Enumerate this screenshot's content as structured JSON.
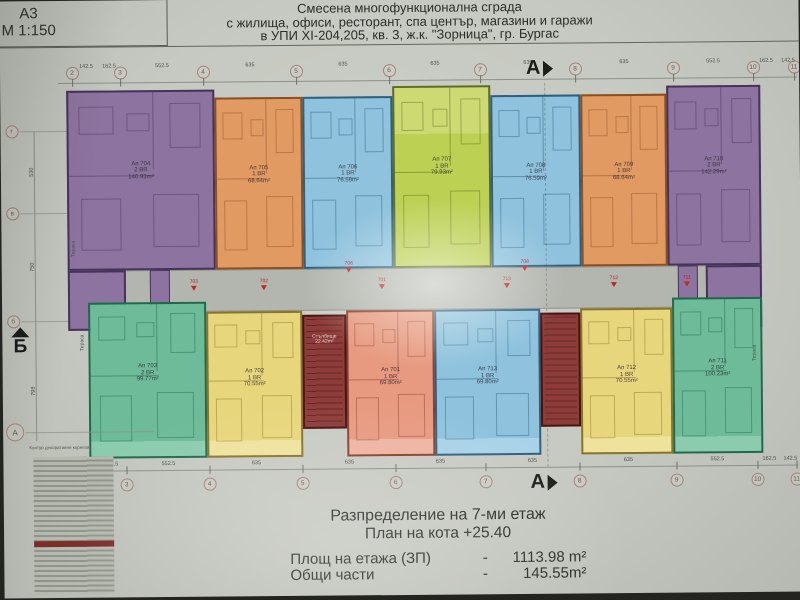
{
  "sheet": {
    "format": "А3",
    "scale": "М 1:150"
  },
  "title": {
    "line1": "Смесена многофункционална сграда",
    "line2": "с жилища, офиси, ресторант, спа център, магазини и  гаражи",
    "line3": "в УПИ XI-204,205, кв. 3, ж.к. \"Зорница\", гр. Бургас"
  },
  "caption": {
    "heading": "Разпределение на 7-ми  етаж",
    "subheading": "План на кота  +25.40",
    "rows": [
      {
        "label": "Площ на етажа (ЗП)",
        "dash": "-",
        "value": "1113.98 m²"
      },
      {
        "label": "Общи части",
        "dash": "-",
        "value": "145.55m²"
      }
    ]
  },
  "plan": {
    "corridor": {
      "x": 70,
      "y": 270,
      "w": 688,
      "h": 42,
      "fill": "#b3b6af",
      "wall": "#90938c"
    },
    "apartments": [
      {
        "no": "Ап 704",
        "type": "2 BR",
        "area": "140.93m²",
        "x": 66,
        "y": 90,
        "w": 148,
        "h": 180,
        "fill": "#8d74a0",
        "wall": "#46335a",
        "light": "#a18bb3",
        "balcony": null,
        "wing": [
          66,
          270,
          58,
          60
        ]
      },
      {
        "no": "Ап 705",
        "type": "1 BR",
        "area": "68.64m²",
        "x": 214,
        "y": 98,
        "w": 88,
        "h": 172,
        "fill": "#e29a63",
        "wall": "#8a4f23",
        "light": "#ecb384",
        "balcony": null
      },
      {
        "no": "Ап 706",
        "type": "1 BR",
        "area": "76.59m²",
        "x": 302,
        "y": 98,
        "w": 90,
        "h": 172,
        "fill": "#8ec2dd",
        "wall": "#2f5f7e",
        "light": "#a8d2e8",
        "balcony": null
      },
      {
        "no": "Ап 707",
        "type": "1 BR",
        "area": "79.93m²",
        "x": 392,
        "y": 88,
        "w": 98,
        "h": 182,
        "fill": "#bcd054",
        "wall": "#5c6c1d",
        "light": "#cdda74",
        "balcony": "top"
      },
      {
        "no": "Ап 708",
        "type": "1 BR",
        "area": "76.59m²",
        "x": 490,
        "y": 98,
        "w": 90,
        "h": 172,
        "fill": "#8ec2dd",
        "wall": "#2f5f7e",
        "light": "#a8d2e8",
        "balcony": null
      },
      {
        "no": "Ап 709",
        "type": "1 BR",
        "area": "68.64m²",
        "x": 580,
        "y": 98,
        "w": 86,
        "h": 172,
        "fill": "#e29a63",
        "wall": "#8a4f23",
        "light": "#ecb384",
        "balcony": null
      },
      {
        "no": "Ап 710",
        "type": "2 BR",
        "area": "142.29m²",
        "x": 666,
        "y": 90,
        "w": 94,
        "h": 180,
        "fill": "#8d74a0",
        "wall": "#46335a",
        "light": "#a18bb3",
        "balcony": null,
        "wing": [
          704,
          270,
          56,
          62
        ]
      },
      {
        "no": "Ап 703",
        "type": "2 BR",
        "area": "99.77m²",
        "x": 86,
        "y": 302,
        "w": 118,
        "h": 156,
        "fill": "#6dbb98",
        "wall": "#1f6a4d",
        "light": "#8bcbae",
        "balcony": "bottom"
      },
      {
        "no": "Ап 702",
        "type": "1 BR",
        "area": "70.55m²",
        "x": 204,
        "y": 312,
        "w": 96,
        "h": 146,
        "fill": "#e8d67c",
        "wall": "#8a7526",
        "light": "#efe29d",
        "balcony": "bottom"
      },
      {
        "no": "Ап 701",
        "type": "1 BR",
        "area": "69.80m²",
        "x": 344,
        "y": 312,
        "w": 88,
        "h": 146,
        "fill": "#e79a80",
        "wall": "#8a3d2a",
        "light": "#eeb3a0",
        "balcony": "bottom"
      },
      {
        "no": "Ап 713",
        "type": "1 BR",
        "area": "69.80m²",
        "x": 432,
        "y": 312,
        "w": 106,
        "h": 146,
        "fill": "#8ec2dd",
        "wall": "#2f5f7e",
        "light": "#a8d2e8",
        "balcony": "bottom"
      },
      {
        "no": "Ап 712",
        "type": "1 BR",
        "area": "70.55m²",
        "x": 578,
        "y": 312,
        "w": 92,
        "h": 146,
        "fill": "#e8d67c",
        "wall": "#8a7526",
        "light": "#efe29d",
        "balcony": "bottom"
      },
      {
        "no": "Ап 711",
        "type": "2 BR",
        "area": "100.23m²",
        "x": 670,
        "y": 302,
        "w": 90,
        "h": 156,
        "fill": "#6dbb98",
        "wall": "#1f6a4d",
        "light": "#8bcbae",
        "balcony": "bottom"
      }
    ],
    "stairs": [
      {
        "label": "Стълбище",
        "area": "22.42m²",
        "x": 300,
        "y": 316,
        "w": 44,
        "h": 114,
        "show_label": true
      },
      {
        "label": "Стълбище",
        "area": "",
        "x": 538,
        "y": 316,
        "w": 40,
        "h": 114,
        "show_label": false
      }
    ],
    "services": [
      {
        "x": 148,
        "y": 270,
        "w": 20,
        "h": 42,
        "fill": "#8d74a0",
        "wall": "#46335a"
      },
      {
        "x": 676,
        "y": 270,
        "w": 20,
        "h": 42,
        "fill": "#8d74a0",
        "wall": "#46335a"
      }
    ],
    "entrance_markers": [
      {
        "n": "706",
        "x": 347,
        "y": 263
      },
      {
        "n": "708",
        "x": 523,
        "y": 263
      },
      {
        "n": "703",
        "x": 192,
        "y": 280
      },
      {
        "n": "702",
        "x": 262,
        "y": 280
      },
      {
        "n": "701",
        "x": 380,
        "y": 280
      },
      {
        "n": "713",
        "x": 505,
        "y": 280
      },
      {
        "n": "712",
        "x": 612,
        "y": 280
      },
      {
        "n": "711",
        "x": 685,
        "y": 280
      }
    ],
    "terrace_labels": [
      {
        "t": "Тераса",
        "x": 72,
        "y": 248
      },
      {
        "t": "Тераса",
        "x": 80,
        "y": 342
      },
      {
        "t": "Тераса",
        "x": 752,
        "y": 358
      }
    ]
  },
  "grid": {
    "top": {
      "line": {
        "x1": 58,
        "x2": 797,
        "y": 82
      },
      "circle_y": 72,
      "dim_y": 63,
      "circles": [
        {
          "n": "2",
          "x": 72
        },
        {
          "n": "3",
          "x": 120
        },
        {
          "n": "4",
          "x": 203
        },
        {
          "n": "5",
          "x": 296
        },
        {
          "n": "6",
          "x": 389
        },
        {
          "n": "7",
          "x": 480
        },
        {
          "n": "8",
          "x": 575
        },
        {
          "n": "9",
          "x": 673
        },
        {
          "n": "10",
          "x": 753
        },
        {
          "n": "11",
          "x": 794
        }
      ],
      "dims": [
        {
          "t": "142.5",
          "x": 86
        },
        {
          "t": "162.5",
          "x": 109
        },
        {
          "t": "552.5",
          "x": 162
        },
        {
          "t": "635",
          "x": 250
        },
        {
          "t": "635",
          "x": 343
        },
        {
          "t": "635",
          "x": 435
        },
        {
          "t": "635",
          "x": 528
        },
        {
          "t": "635",
          "x": 624
        },
        {
          "t": "552.5",
          "x": 713
        },
        {
          "t": "162.5",
          "x": 766
        },
        {
          "t": "142.5",
          "x": 788
        }
      ]
    },
    "bottom": {
      "line": {
        "x1": 100,
        "x2": 795,
        "y": 470
      },
      "circle_y": 484,
      "dim_y": 461,
      "circles": [
        {
          "n": "3",
          "x": 123
        },
        {
          "n": "4",
          "x": 206
        },
        {
          "n": "5",
          "x": 299
        },
        {
          "n": "6",
          "x": 392
        },
        {
          "n": "7",
          "x": 482
        },
        {
          "n": "8",
          "x": 576
        },
        {
          "n": "9",
          "x": 673
        },
        {
          "n": "10",
          "x": 754
        },
        {
          "n": "11",
          "x": 793
        }
      ],
      "dims": [
        {
          "t": "142.5",
          "x": 108
        },
        {
          "t": "552.5",
          "x": 165
        },
        {
          "t": "635",
          "x": 253
        },
        {
          "t": "635",
          "x": 346
        },
        {
          "t": "635",
          "x": 437
        },
        {
          "t": "635",
          "x": 529
        },
        {
          "t": "635",
          "x": 625
        },
        {
          "t": "552.5",
          "x": 714
        },
        {
          "t": "162.5",
          "x": 766
        },
        {
          "t": "142.5",
          "x": 787
        }
      ]
    },
    "left": {
      "circles": [
        {
          "n": "г",
          "y": 130
        },
        {
          "n": "в",
          "y": 212
        },
        {
          "n": "б",
          "y": 320
        }
      ],
      "dims": [
        {
          "t": "530",
          "y": 171
        },
        {
          "t": "750",
          "y": 266
        },
        {
          "t": "798",
          "y": 390
        }
      ],
      "a_circle": {
        "n": "А",
        "y": 431
      },
      "note": "Контур декоративни корнизи"
    }
  },
  "section_markers": {
    "top": {
      "label": "А",
      "x": 526,
      "y": 60
    },
    "bottom": {
      "label": "А",
      "x": 527,
      "y": 474
    },
    "left": {
      "label": "Б"
    }
  },
  "legend_corner": {
    "lines": [
      "Ателиет",
      "1 В",
      "2 В"
    ]
  }
}
